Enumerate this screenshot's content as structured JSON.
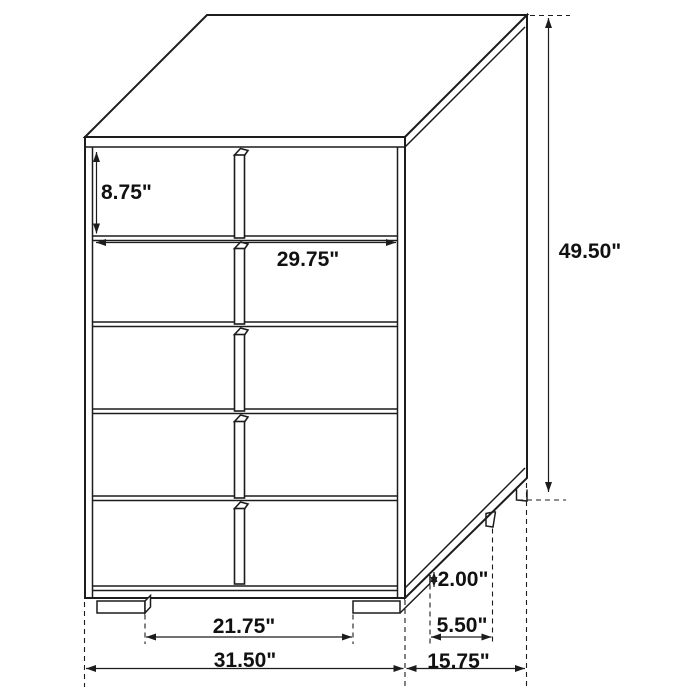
{
  "diagram": {
    "subject": "5-drawer chest dimension diagram",
    "background_color": "#ffffff",
    "line_color": "#1c1c1c",
    "text_color": "#111111",
    "labels": {
      "drawer_height": "8.75\"",
      "drawer_width": "29.75\"",
      "overall_height": "49.50\"",
      "base_height": "2.00\"",
      "foot_spacing_depth": "5.50\"",
      "overall_depth": "15.75\"",
      "foot_spacing_width": "21.75\"",
      "overall_width": "31.50\""
    }
  }
}
